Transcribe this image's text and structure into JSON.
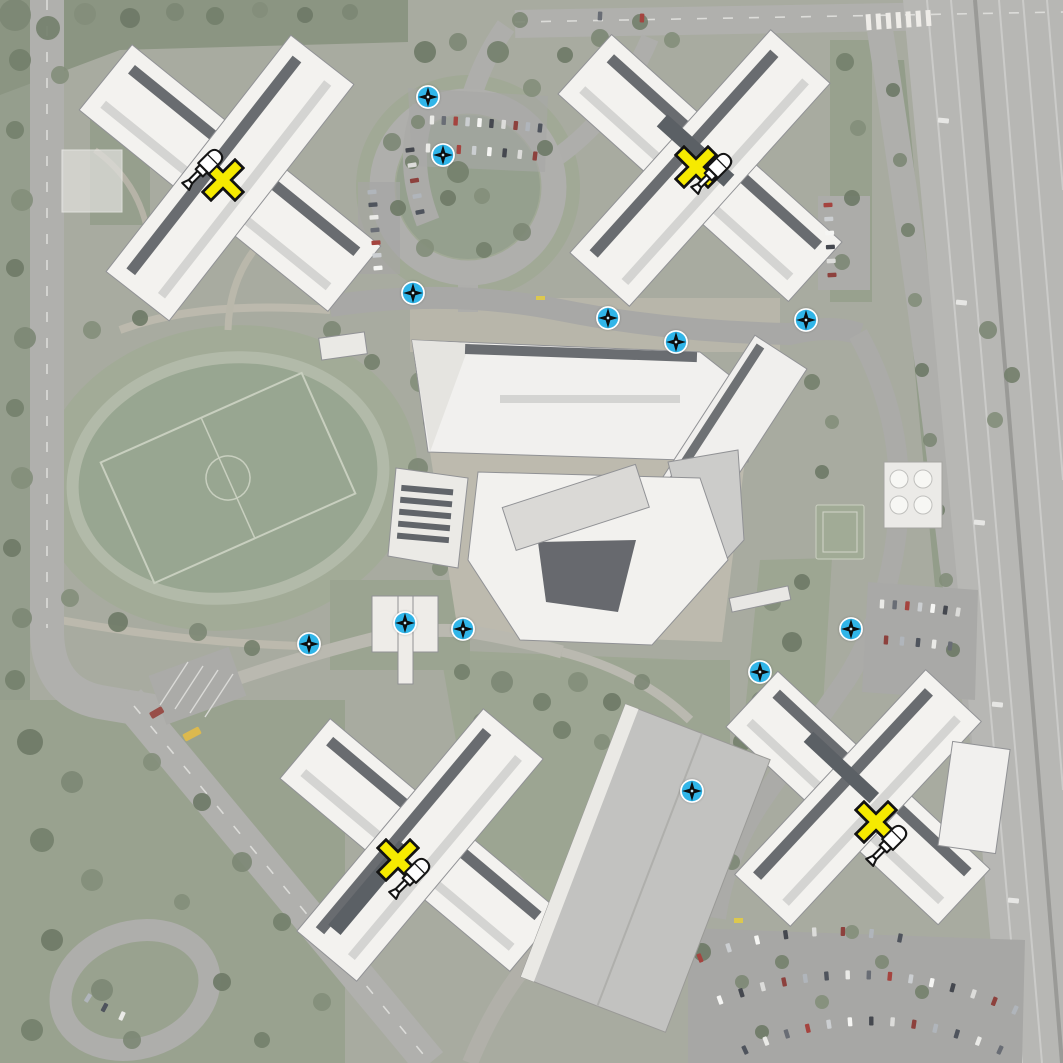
{
  "scene": {
    "type": "aerial-satellite-map",
    "label": "Campus overhead view with mission markers"
  },
  "icons": {
    "repair_cross": "x-mark-icon",
    "repair_tool": "screwdriver-icon",
    "waypoint": "compass-star-icon"
  },
  "markers": {
    "repair_sites": [
      {
        "x": 223,
        "y": 180,
        "tool_dx": -21,
        "tool_dy": -9
      },
      {
        "x": 696,
        "y": 167,
        "tool_dx": 15,
        "tool_dy": 8
      },
      {
        "x": 398,
        "y": 860,
        "tool_dx": 11,
        "tool_dy": 20
      },
      {
        "x": 876,
        "y": 822,
        "tool_dx": 10,
        "tool_dy": 25
      }
    ],
    "waypoints": [
      {
        "x": 428,
        "y": 97
      },
      {
        "x": 443,
        "y": 155
      },
      {
        "x": 413,
        "y": 293
      },
      {
        "x": 608,
        "y": 318
      },
      {
        "x": 676,
        "y": 342
      },
      {
        "x": 806,
        "y": 320
      },
      {
        "x": 405,
        "y": 623
      },
      {
        "x": 463,
        "y": 629
      },
      {
        "x": 309,
        "y": 644
      },
      {
        "x": 851,
        "y": 629
      },
      {
        "x": 760,
        "y": 672
      },
      {
        "x": 692,
        "y": 791
      }
    ]
  },
  "colors": {
    "waypoint_fill": "#31b5e8",
    "waypoint_ring": "#ffffff",
    "waypoint_star": "#0d0d0d",
    "waypoint_dot": "#bfe9f8",
    "cross_fill": "#f6ea00",
    "cross_outline": "#121212",
    "tool_fill": "#ffffff",
    "tool_outline": "#141414"
  }
}
